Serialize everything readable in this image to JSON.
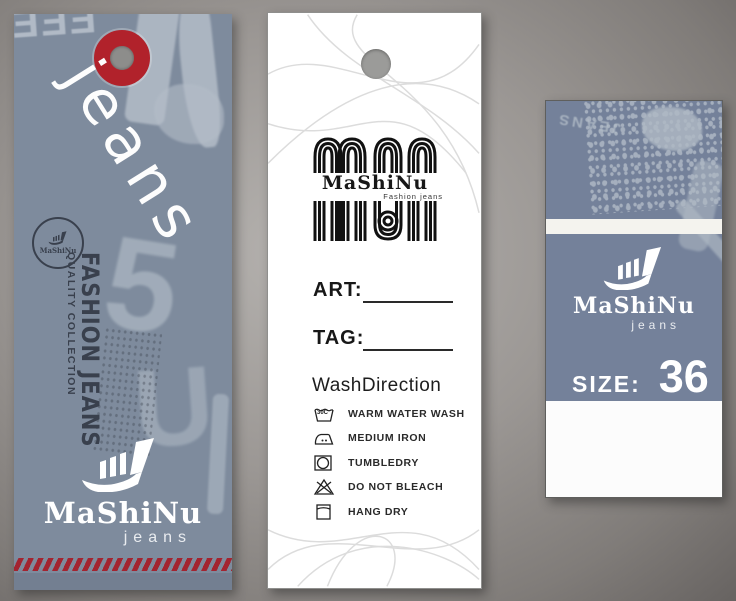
{
  "title": "MaShiNu jeans hang tag set",
  "colors": {
    "accent_red": "#b1222b",
    "stripe_red": "#a32430",
    "left_tag_gray": "#7e8b9d",
    "right_tag_gray": "#74819a",
    "card_white": "#ffffff",
    "ink_black": "#171717"
  },
  "left_tag": {
    "jeans_script": "jeans",
    "stamp_text": "MaShiNu",
    "vertical_title": "FASHION JEANS",
    "vertical_subtitle": "QUALITY COLLECTION",
    "brand": "MaShiNu",
    "brand_sub": "jeans"
  },
  "middle_tag": {
    "logo_brand": "MaShiNu",
    "logo_sub": "Fashion jeans",
    "art_label": "ART:",
    "tag_label": "TAG:",
    "wash_title": "WashDirection",
    "wash_temp": "30C",
    "care_items": [
      {
        "icon": "wash-basin-icon",
        "label": "WARM WATER WASH"
      },
      {
        "icon": "iron-icon",
        "label": "MEDIUM IRON"
      },
      {
        "icon": "tumble-dry-icon",
        "label": "TUMBLEDRY"
      },
      {
        "icon": "do-not-bleach-icon",
        "label": "DO NOT BLEACH"
      },
      {
        "icon": "hang-dry-icon",
        "label": "HANG DRY"
      }
    ]
  },
  "right_tag": {
    "grunge_text": "JEANS",
    "brand": "MaShiNu",
    "brand_sub": "jeans",
    "size_label": "SIZE:",
    "size_value": "36"
  }
}
